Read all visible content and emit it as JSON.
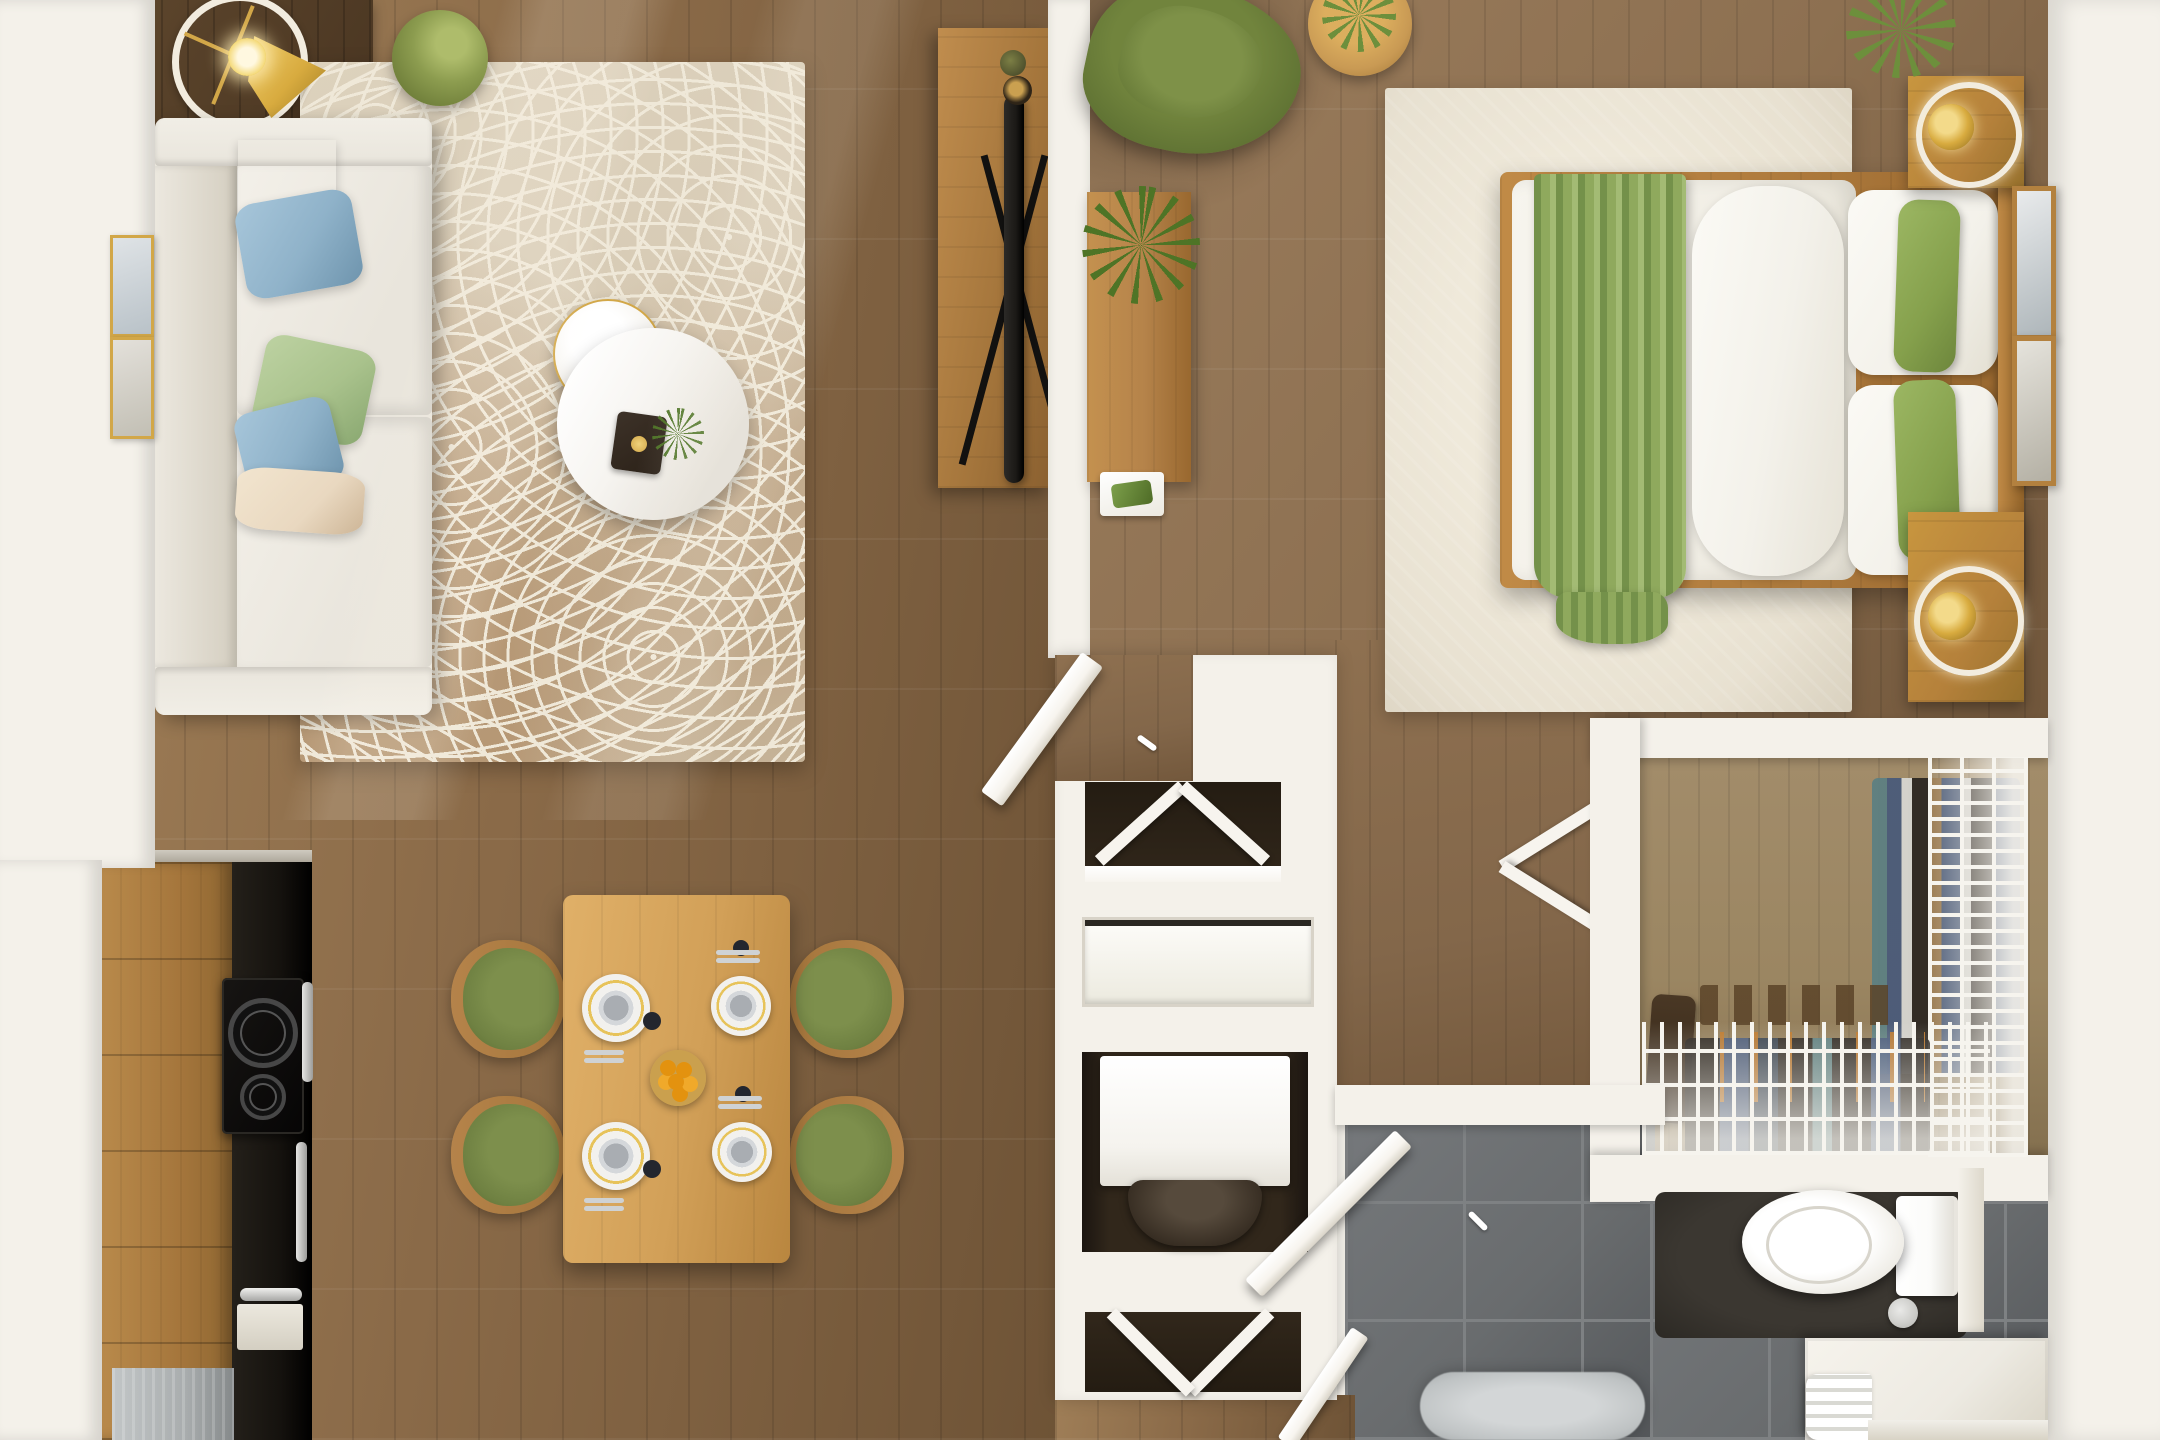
{
  "scene": {
    "title": "Top-down 3D render of a one-bedroom apartment floor plan",
    "view": "top-down orthographic",
    "style": "photorealistic furnished dollhouse render",
    "rooms": [
      {
        "name": "living-room",
        "furniture": [
          "white sectional sofa",
          "cream throw pillow",
          "blue throw pillow",
          "green throw pillow",
          "patterned beige area rug",
          "round marble nesting coffee tables",
          "black tray with gold accent",
          "arc floor lamp",
          "green side stool",
          "dark wood console table",
          "two gold gallery frames",
          "wood tv console",
          "flat screen tv",
          "decor vases"
        ]
      },
      {
        "name": "dining-area",
        "furniture": [
          "oak dining table",
          "four green dining chairs",
          "four place settings",
          "fruit bowl with oranges"
        ]
      },
      {
        "name": "kitchen",
        "furniture": [
          "wood cabinet run",
          "black counter run",
          "two burner cooktop",
          "oven with silver handle",
          "stainless appliance"
        ]
      },
      {
        "name": "bedroom",
        "furniture": [
          "platform bed with white duvet",
          "green throw blanket",
          "white body pillow",
          "white pillows",
          "green lumbar pillows",
          "wood headboard",
          "two wood nightstands",
          "two gold table lamps with white rings",
          "cream area rug",
          "green accent armchair",
          "round wood side table with plant",
          "wall desk with fern and tray",
          "two leaning wall frames"
        ]
      },
      {
        "name": "walk-in-closet",
        "furniture": [
          "white wire shelving unit",
          "hanging clothes",
          "shoe shelf",
          "boots"
        ]
      },
      {
        "name": "bathroom",
        "furniture": [
          "toilet with tank",
          "white vanity counter",
          "folded towels",
          "fluffy gray bath rug",
          "gray tile floor",
          "open door"
        ]
      },
      {
        "name": "hall-utility",
        "furniture": [
          "washer niche",
          "storage niche",
          "bifold chevron doors",
          "open hall door",
          "double bedroom doors"
        ]
      }
    ]
  },
  "palette": {
    "wall": "#f4f1ea",
    "wallShade": "#ddd7ca",
    "floorLiving": "#8a6a48",
    "floorLivingDark": "#6e5336",
    "floorLivingLight": "#9f7e57",
    "floorBedroom": "#8d7051",
    "floorHall": "#83674a",
    "floorCloset": "#9b8662",
    "consoleDark": "#4a3622",
    "rugBase": "#d5c8b2",
    "rugLine": "#efe8d8",
    "rugTan": "#b2916c",
    "bedRug": "#e8e1d1",
    "sofaBase": "#e9e5dc",
    "sofaShade": "#d4cec0",
    "pillowCream": "#e9d8c0",
    "pillowBlue": "#8fb2c9",
    "pillowGreen": "#a9c28c",
    "accentGreen": "#5f7233",
    "seatGreen": "#6f8142",
    "stoolGreen": "#8c9c4f",
    "marble": "#f6f4f0",
    "gold": "#d2a748",
    "trayDark": "#2b2118",
    "tableOak": "#d2a058",
    "chairWood": "#a5763c",
    "plateWhite": "#f2f1ee",
    "bowlGray": "#a9adb2",
    "orange": "#e3920f",
    "napkinDark": "#23262e",
    "bedFrame": "#b07c3e",
    "duvetWhite": "#f0ede4",
    "throwGreen": "#8fa95d",
    "throwGreenDark": "#74914a",
    "pillowWhite": "#f3f1ea",
    "bedGreen": "#85a04c",
    "nightWood": "#b5813b",
    "lampGold": "#d8ab3f",
    "ringWhite": "#f2ecdf",
    "deskWood": "#b5834a",
    "fernGreen": "#4e7426",
    "plantGreen": "#6d8f3c",
    "tvBlack": "#1b1916",
    "kitchenBlack": "#15120e",
    "steel": "#a9adae",
    "tileBase": "#696c6e",
    "tileGrout": "#7e8183",
    "tileDark": "#54575a",
    "toiletWhite": "#fbfbf9",
    "counterWhite": "#edeae2",
    "bathRug": "#bfc3c4",
    "doorWhite": "#f7f4ee",
    "alcoveDark": "#31271b",
    "washerWhite": "#f5f3ee",
    "drumDark": "#392f24",
    "clothesTeal": "#5b7f82",
    "clothesDenim": "#47597a",
    "clothesWhite": "#d8d8d4",
    "clothesDark": "#29241f",
    "clothesTan": "#9a7a50",
    "hangerOrange": "#c07a2c",
    "wireWhite": "#f6f4ee"
  }
}
